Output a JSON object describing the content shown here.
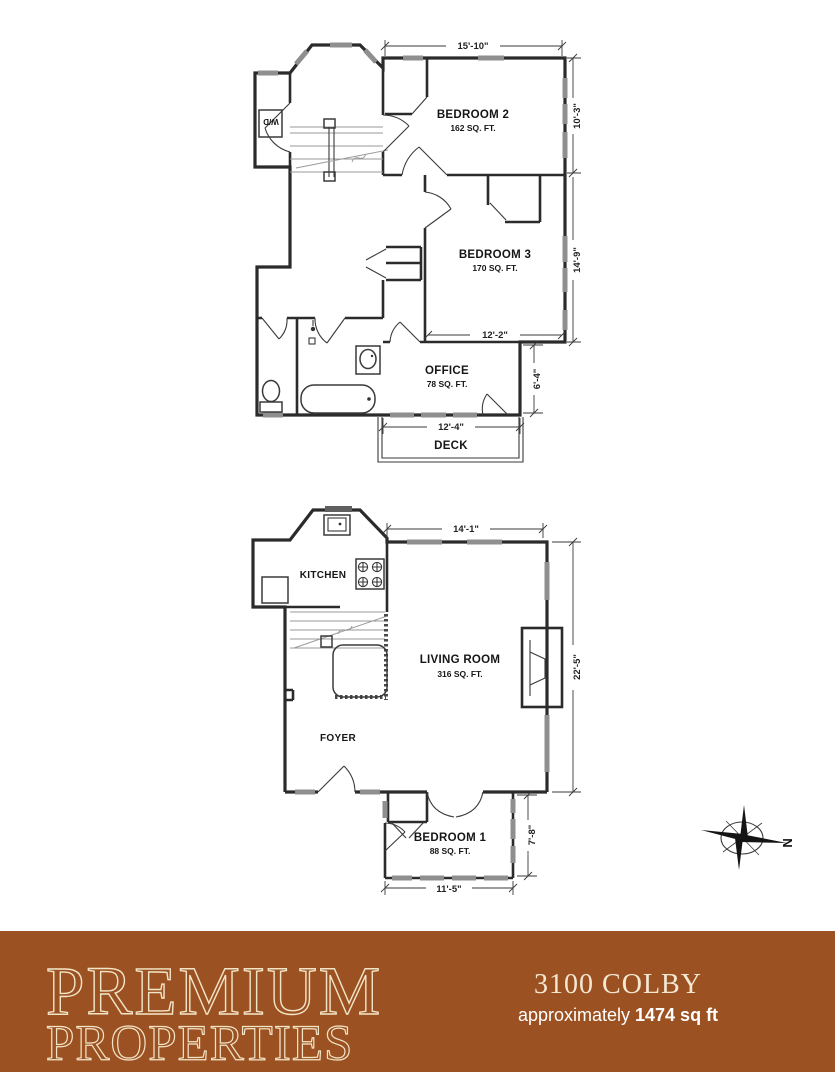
{
  "upper": {
    "bedroom2_name": "BEDROOM 2",
    "bedroom2_area": "162 SQ. FT.",
    "bedroom3_name": "BEDROOM 3",
    "bedroom3_area": "170 SQ. FT.",
    "office_name": "OFFICE",
    "office_area": "78 SQ. FT.",
    "deck_name": "DECK",
    "laundry_label": "W/D",
    "dim_top": "15'-10\"",
    "dim_right_upper": "10'-3\"",
    "dim_right_lower": "14'-9\"",
    "dim_bed3_width": "12'-2\"",
    "dim_office_height": "6'-4\"",
    "dim_office_width": "12'-4\""
  },
  "main": {
    "kitchen_name": "KITCHEN",
    "living_name": "LIVING ROOM",
    "living_area": "316 SQ. FT.",
    "foyer_name": "FOYER",
    "bedroom1_name": "BEDROOM 1",
    "bedroom1_area": "88 SQ. FT.",
    "dim_top": "14'-1\"",
    "dim_right": "22'-5\"",
    "dim_bed1_height": "7'-8\"",
    "dim_bed1_width": "11'-5\""
  },
  "compass": {
    "north_label": "N"
  },
  "footer": {
    "brand_line1": "PREMIUM",
    "brand_line2": "PROPERTIES",
    "address": "3100 COLBY",
    "area_prefix": "approximately",
    "area_value": "1474 sq ft",
    "banner_color": "#9b5121",
    "brand_text_color": "#f2e4c7"
  }
}
